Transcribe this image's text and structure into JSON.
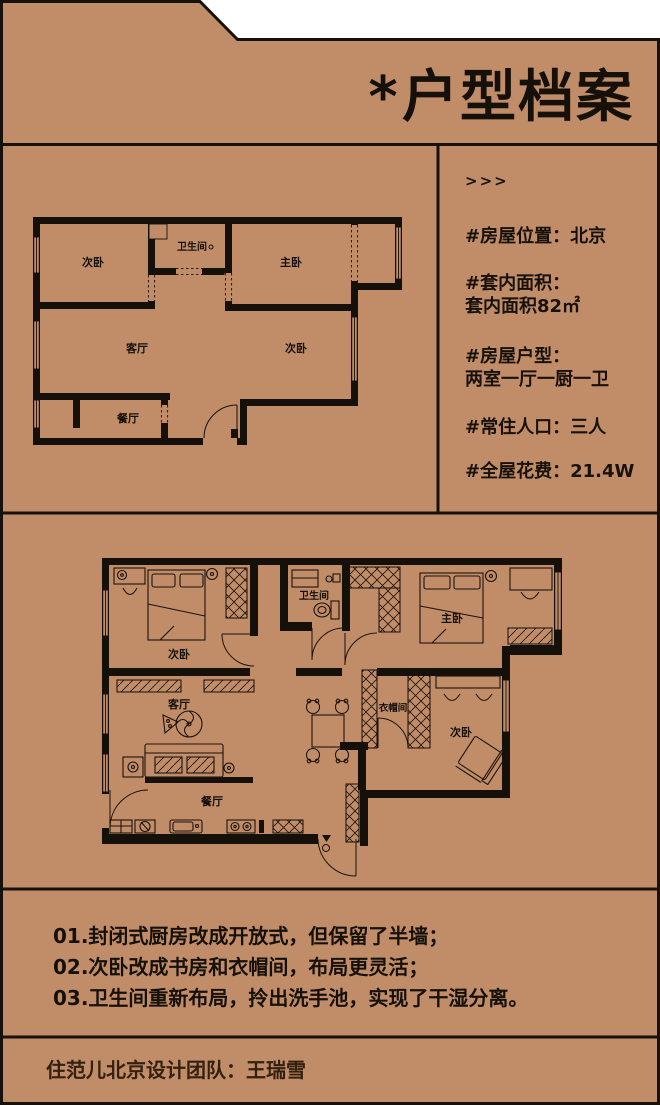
{
  "header": {
    "title": "*户型档案"
  },
  "info": {
    "arrows": ">>>",
    "location": "#房屋位置：北京",
    "area_label": "#套内面积：",
    "area_value": "套内面积82㎡",
    "layout_label": "#房屋户型：",
    "layout_value": "两室一厅一厨一卫",
    "residents": "#常住人口：三人",
    "cost": "#全屋花费：21.4W"
  },
  "plan_before": {
    "rooms": {
      "bedroom2_top": "次卧",
      "bathroom": "卫生间",
      "master": "主卧",
      "living": "客厅",
      "bedroom2_mid": "次卧",
      "dining": "餐厅"
    }
  },
  "plan_after": {
    "rooms": {
      "bedroom2": "次卧",
      "bathroom": "卫生间",
      "master": "主卧",
      "living": "客厅",
      "closet": "衣帽间",
      "study": "次卧",
      "dining": "餐厅"
    }
  },
  "notes": [
    "01.封闭式厨房改成开放式，但保留了半墙；",
    "02.次卧改成书房和衣帽间，布局更灵活；",
    "03.卫生间重新布局，拎出洗手池，实现了干湿分离。"
  ],
  "footer": {
    "credit": "住范儿北京设计团队：王瑞雪"
  },
  "colors": {
    "background": "#c18d69",
    "line": "#17110b",
    "outside": "#ffffff"
  }
}
